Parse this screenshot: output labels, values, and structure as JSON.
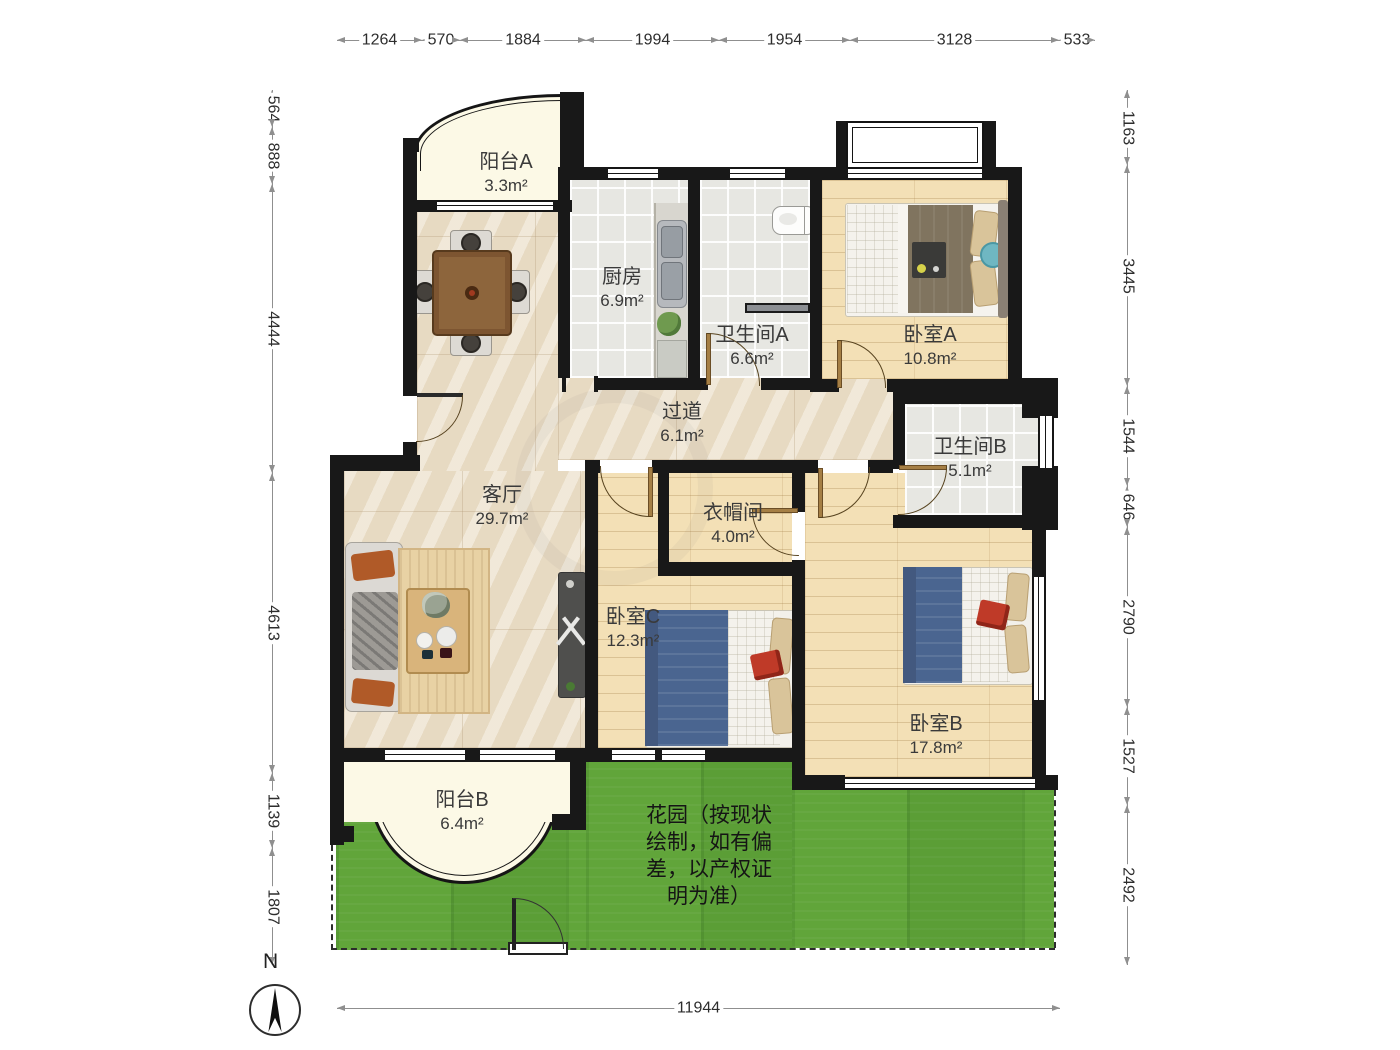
{
  "compass": {
    "label": "N"
  },
  "dims": {
    "top": [
      "1264",
      "570",
      "1884",
      "1994",
      "1954",
      "3128",
      "533"
    ],
    "left": [
      "564",
      "888",
      "4444",
      "4613",
      "1139",
      "1807"
    ],
    "right": [
      "1163",
      "3445",
      "1544",
      "646",
      "2790",
      "1527",
      "2492"
    ],
    "bottom": [
      "11944"
    ]
  },
  "rooms": {
    "balcony_a": {
      "name": "阳台A",
      "area": "3.3m²"
    },
    "kitchen": {
      "name": "厨房",
      "area": "6.9m²"
    },
    "bath_a": {
      "name": "卫生间A",
      "area": "6.6m²"
    },
    "bed_a": {
      "name": "卧室A",
      "area": "10.8m²"
    },
    "hallway": {
      "name": "过道",
      "area": "6.1m²"
    },
    "bath_b": {
      "name": "卫生间B",
      "area": "5.1m²"
    },
    "living": {
      "name": "客厅",
      "area": "29.7m²"
    },
    "closet": {
      "name": "衣帽间",
      "area": "4.0m²"
    },
    "bed_c": {
      "name": "卧室C",
      "area": "12.3m²"
    },
    "bed_b": {
      "name": "卧室B",
      "area": "17.8m²"
    },
    "balcony_b": {
      "name": "阳台B",
      "area": "6.4m²"
    },
    "garden": {
      "note": "花园（按现状\n绘制，如有偏\n差，以产权证\n　明为准）"
    }
  },
  "colors": {
    "wall": "#181818",
    "wood": "#f3e0b6",
    "tile": "#e7e7e2",
    "marble": "#ece0ca",
    "balcony": "#fcf9e6",
    "garden_green": "#61a53a",
    "bed_blue": "#4a6590",
    "accent_orange": "#b05a28"
  }
}
